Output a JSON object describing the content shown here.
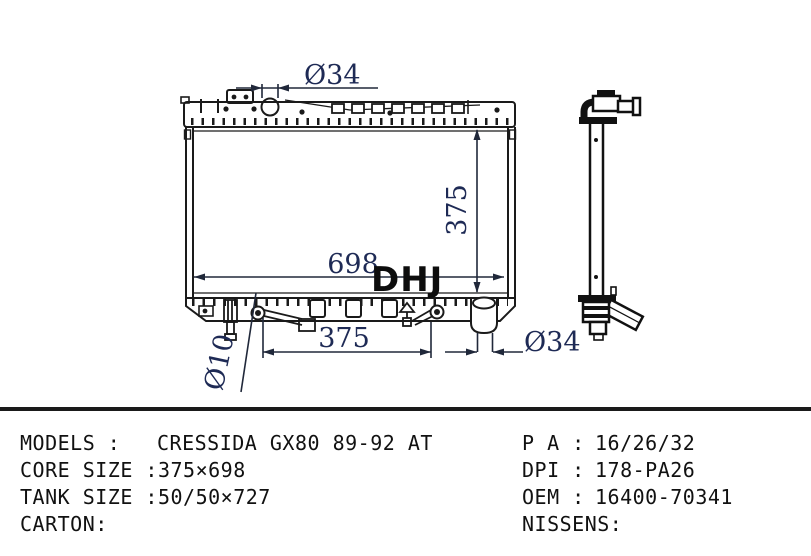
{
  "title": "radiator technical drawing",
  "watermark": "DHJ",
  "colors": {
    "line": "#1a1a1a",
    "dimension_text": "#1e2a55",
    "watermark": "#0d0d0d",
    "spec_text": "#111111",
    "background": "#ffffff"
  },
  "drawing": {
    "dimensions": {
      "filler_neck_diameter": "Ø34",
      "core_height": "375",
      "core_width": "698",
      "mount_span": "375",
      "outlet_pipe_diameter": "Ø34",
      "pin_hole_diameter": "Ø10"
    }
  },
  "specs": {
    "left": [
      {
        "label": "MODELS :",
        "value": "CRESSIDA GX80 89-92 AT"
      },
      {
        "label": "CORE SIZE :",
        "value": "375×698"
      },
      {
        "label": "TANK SIZE :",
        "value": "50/50×727"
      },
      {
        "label": "CARTON:",
        "value": ""
      }
    ],
    "right": [
      {
        "label": "P A :",
        "value": "16/26/32"
      },
      {
        "label": "DPI :",
        "value": "178-PA26"
      },
      {
        "label": "OEM :",
        "value": "16400-70341"
      },
      {
        "label": "NISSENS:",
        "value": ""
      }
    ]
  }
}
